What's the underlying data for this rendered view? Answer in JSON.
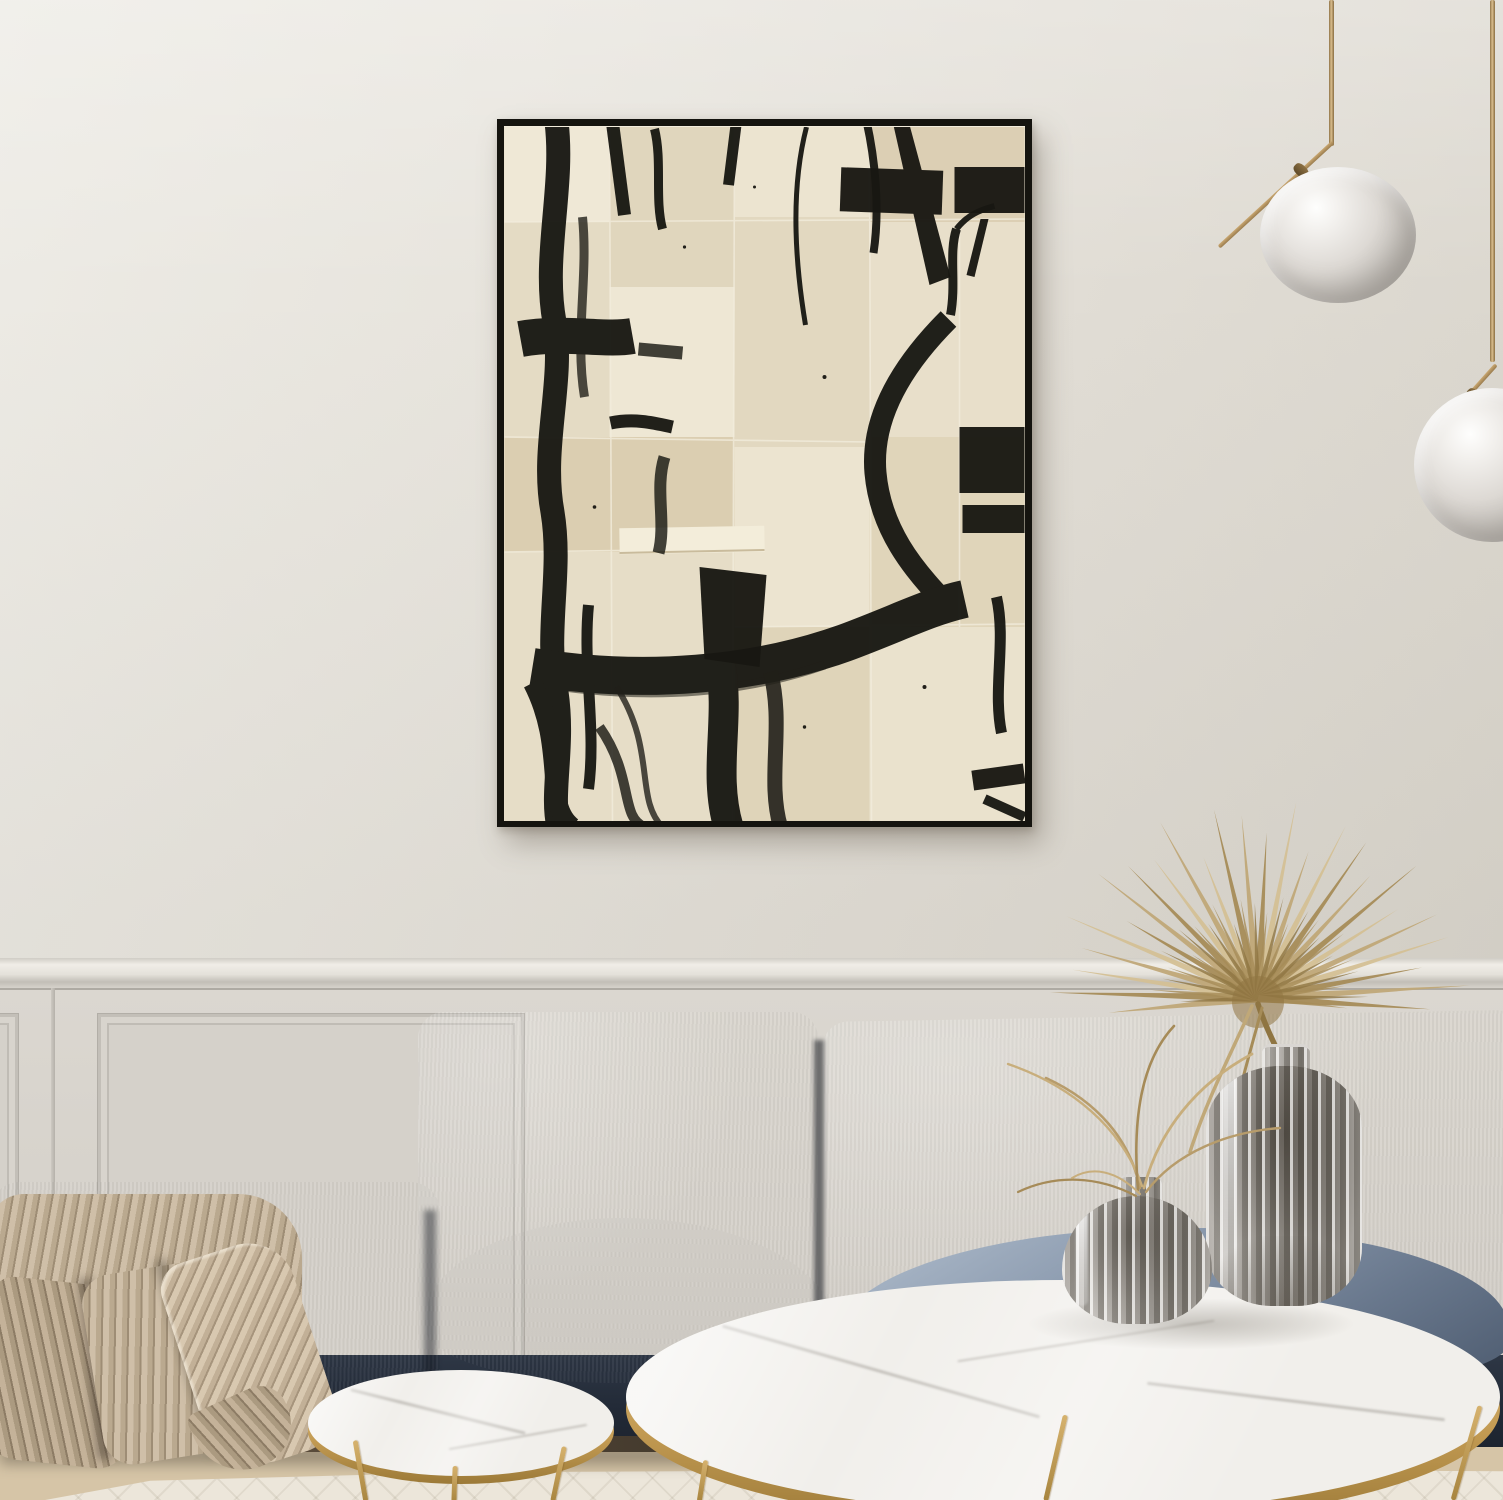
{
  "scene": {
    "description": "Photorealistic interior mockup: modern living room with a large framed abstract black-ink collage artwork on a cream wall, brass pendant globe lights, a navy blue velvet modular sofa with a chunky-knit beige throw, nesting round marble coffee tables with gold frames, ribbed smoked-glass vases holding a dried fan palm and grasses, herringbone wood floor and a pale rug",
    "objects": {
      "artwork": "abstract black brush strokes on stitched cream canvas patches in a thin black frame",
      "pendant_lights": "two brass stem pendants with white glass globes",
      "sofa": "navy blue velvet modular sofa with light blue-grey seat cushions",
      "throw_blanket": "chunky braided knit throw in warm beige",
      "coffee_tables": "two nesting round white marble tables with gold rims and legs",
      "vases": "tall and squat ribbed smoked-glass vases",
      "plants": "dried gold fan palm leaf and wispy dried grasses",
      "floor": "light herringbone parquet with cream berber rug",
      "walls": "warm off-white wall with classic wainscoting and chair rail"
    },
    "palette": {
      "wall": "#e7e3dc",
      "wainscot": "#d8d4cd",
      "art_background": "#e8e0cc",
      "art_ink": "#181712",
      "frame": "#15140f",
      "brass": "#c09a5e",
      "sofa_navy": "#2c3442",
      "sofa_seat": "#93a1b4",
      "blanket": "#c1b098",
      "marble": "#f1efeb",
      "gold": "#c29a52",
      "glass": "#a8a49f",
      "floor_wood": "#d6c5a7",
      "rug": "#ece6da",
      "palm": {
        "light": "#d4c095",
        "mid": "#c0a878",
        "dark": "#a68c58",
        "core": "#8f7542"
      }
    }
  }
}
